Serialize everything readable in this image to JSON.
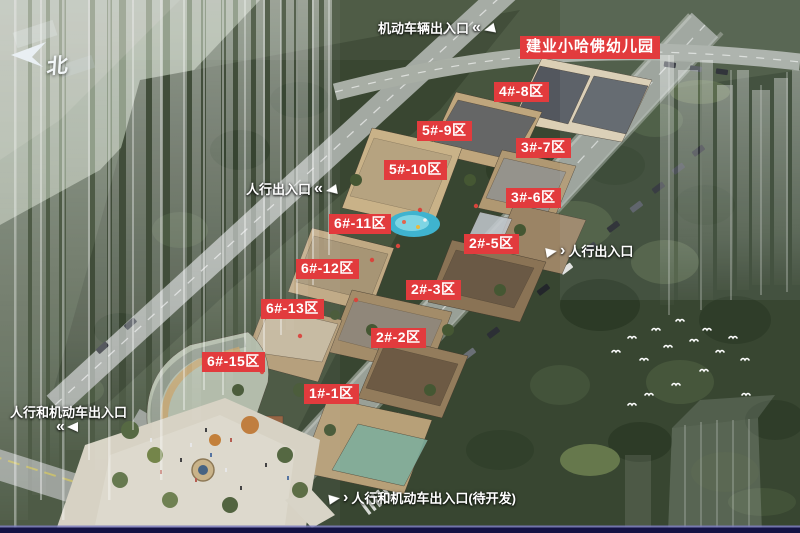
{
  "banner": {
    "text": "建业小哈佛幼儿园"
  },
  "compass": {
    "north": "北"
  },
  "zones": [
    {
      "id": "4-8",
      "label": "4#-8区"
    },
    {
      "id": "5-9",
      "label": "5#-9区"
    },
    {
      "id": "3-7",
      "label": "3#-7区"
    },
    {
      "id": "5-10",
      "label": "5#-10区"
    },
    {
      "id": "3-6",
      "label": "3#-6区"
    },
    {
      "id": "6-11",
      "label": "6#-11区"
    },
    {
      "id": "2-5",
      "label": "2#-5区"
    },
    {
      "id": "6-12",
      "label": "6#-12区"
    },
    {
      "id": "2-3",
      "label": "2#-3区"
    },
    {
      "id": "6-13",
      "label": "6#-13区"
    },
    {
      "id": "2-2",
      "label": "2#-2区"
    },
    {
      "id": "6-15",
      "label": "6#-15区"
    },
    {
      "id": "1-1",
      "label": "1#-1区"
    }
  ],
  "entrances": {
    "vehicle_top": "机动车辆出入口",
    "pedestrian_left": "人行出入口",
    "pedestrian_right": "人行出入口",
    "pedestrian_vehicle_left": "人行和机动车出入口",
    "pedestrian_vehicle_bottom": "人行和机动车出入口(待开发)"
  },
  "icons": {
    "chevron_double_left": "«",
    "chevron_right": "›"
  },
  "colors": {
    "badge_red": "#e23b3d",
    "label_white": "#ffffff",
    "bottom_bar": "#131244"
  }
}
